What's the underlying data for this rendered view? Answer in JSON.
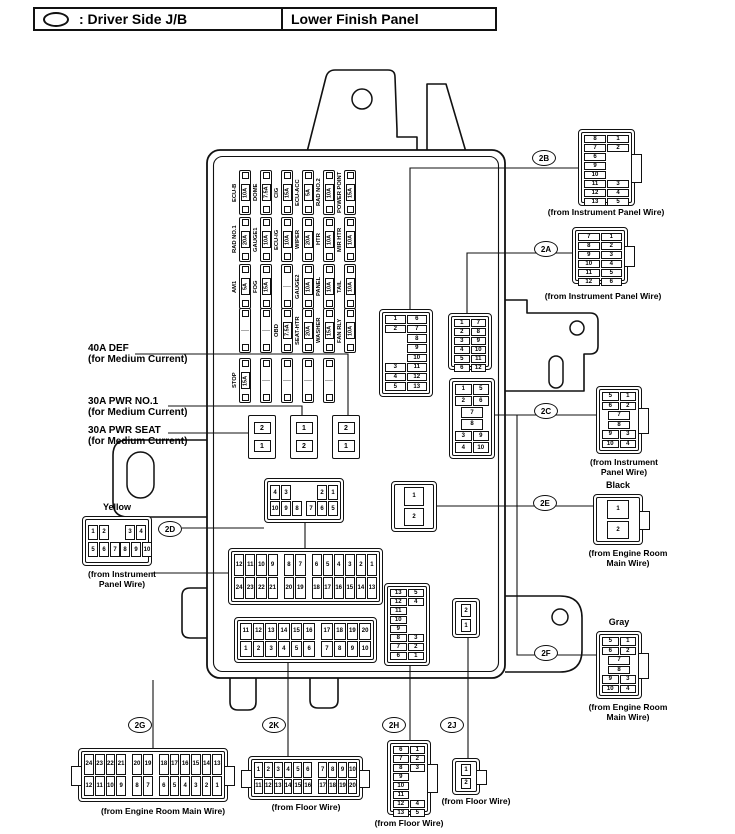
{
  "header": {
    "legend_symbol": "oval-icon",
    "legend_label": ": Driver Side J/B",
    "location_label": "Lower Finish Panel"
  },
  "medium_current_labels": [
    {
      "line1": "40A DEF",
      "line2": "(for Medium Current)"
    },
    {
      "line1": "30A PWR NO.1",
      "line2": "(for Medium Current)"
    },
    {
      "line1": "30A PWR SEAT",
      "line2": "(for Medium Current)"
    }
  ],
  "medium_current_blocks": [
    [
      "2",
      "1"
    ],
    [
      "1",
      "2"
    ],
    [
      "2",
      "1"
    ]
  ],
  "fuse_rows": [
    {
      "fuses": [
        {
          "name": "ECU-B",
          "rating": "10A"
        },
        {
          "name": "DOME",
          "rating": "7.5A"
        },
        {
          "name": "CIG",
          "rating": "15A"
        },
        {
          "name": "ECU-ACC",
          "rating": "5A"
        },
        {
          "name": "RAD NO.2",
          "rating": "10A"
        },
        {
          "name": "POWER POINT",
          "rating": "15A"
        }
      ]
    },
    {
      "fuses": [
        {
          "name": "RAD NO.1",
          "rating": "20A"
        },
        {
          "name": "GAUGE1",
          "rating": "10A"
        },
        {
          "name": "ECU-IG",
          "rating": "10A"
        },
        {
          "name": "WIPER",
          "rating": "20A"
        },
        {
          "name": "HTR",
          "rating": "10A"
        },
        {
          "name": "MIR HTR",
          "rating": "10A"
        }
      ]
    },
    {
      "fuses": [
        {
          "name": "AM1",
          "rating": "5A"
        },
        {
          "name": "FOG",
          "rating": "15A"
        },
        {
          "blank": true
        },
        {
          "name": "GAUGE2",
          "rating": "10A"
        },
        {
          "name": "PANEL",
          "rating": "10A"
        },
        {
          "name": "TAIL",
          "rating": "10A"
        }
      ]
    },
    {
      "fuses": [
        {
          "blank": true
        },
        {
          "blank": true
        },
        {
          "name": "OBD",
          "rating": "7.5A"
        },
        {
          "name": "SEAT-HTR",
          "rating": "20A"
        },
        {
          "name": "WASHER",
          "rating": "15A"
        },
        {
          "name": "FAN RLY",
          "rating": "10A"
        }
      ]
    },
    {
      "fuses": [
        {
          "name": "STOP",
          "rating": "15A"
        },
        {
          "blank": true
        },
        {
          "blank": true
        },
        {
          "blank": true
        },
        {
          "blank": true
        }
      ]
    }
  ],
  "connectors": [
    {
      "id": "jb2b",
      "type": "pairs",
      "pins": [
        [
          "1",
          "6"
        ],
        [
          "2",
          "7"
        ],
        [
          "",
          "8"
        ],
        [
          "",
          "9"
        ],
        [
          "",
          "10"
        ],
        [
          "3",
          "11"
        ],
        [
          "4",
          "12"
        ],
        [
          "5",
          "13"
        ]
      ]
    },
    {
      "id": "jb2a",
      "type": "pairs",
      "pins": [
        [
          "1",
          "7"
        ],
        [
          "2",
          "8"
        ],
        [
          "3",
          "9"
        ],
        [
          "4",
          "10"
        ],
        [
          "5",
          "11"
        ],
        [
          "6",
          "12"
        ]
      ]
    },
    {
      "id": "jb2c",
      "type": "pairs",
      "pins": [
        [
          "1",
          "5"
        ],
        [
          "2",
          "6"
        ],
        [
          "7"
        ],
        [
          "8"
        ],
        [
          "3",
          "9"
        ],
        [
          "4",
          "10"
        ]
      ]
    },
    {
      "id": "jb2d",
      "type": "dgroups",
      "pins": {
        "top": [
          [
            "4",
            "3"
          ],
          [
            "2",
            "1"
          ]
        ],
        "bottom": [
          [
            "10",
            "9",
            "8"
          ],
          [
            "7",
            "6",
            "5"
          ]
        ]
      }
    },
    {
      "id": "jb2e",
      "type": "vstack",
      "pins": [
        "1",
        "2"
      ]
    },
    {
      "id": "jb2g",
      "type": "groups",
      "pins": {
        "top": [
          [
            "12",
            "11",
            "10",
            "9"
          ],
          [
            "8",
            "7"
          ],
          [
            "6",
            "5",
            "4",
            "3",
            "2",
            "1"
          ]
        ],
        "bottom": [
          [
            "24",
            "23",
            "22",
            "21"
          ],
          [
            "20",
            "19"
          ],
          [
            "18",
            "17",
            "16",
            "15",
            "14",
            "13"
          ]
        ]
      }
    },
    {
      "id": "jb2k",
      "type": "groups",
      "pins": {
        "top": [
          [
            "11",
            "12",
            "13",
            "14",
            "15",
            "16"
          ],
          [
            "17",
            "18",
            "19",
            "20"
          ]
        ],
        "bottom": [
          [
            "1",
            "2",
            "3",
            "4",
            "5",
            "6"
          ],
          [
            "7",
            "8",
            "9",
            "10"
          ]
        ]
      }
    },
    {
      "id": "jb2h",
      "type": "pairs",
      "pins": [
        [
          "13",
          "5"
        ],
        [
          "12",
          "4"
        ],
        [
          "11",
          ""
        ],
        [
          "10",
          ""
        ],
        [
          "9",
          ""
        ],
        [
          "8",
          "3"
        ],
        [
          "7",
          "2"
        ],
        [
          "6",
          "1"
        ]
      ]
    },
    {
      "id": "jb2j",
      "type": "vstack",
      "pins": [
        "2",
        "1"
      ]
    },
    {
      "id": "ext2b",
      "type": "pairs",
      "ref": "2B",
      "caption": "(from Instrument Panel Wire)",
      "pins": [
        [
          "8",
          "1"
        ],
        [
          "7",
          "2"
        ],
        [
          "6",
          ""
        ],
        [
          "9",
          ""
        ],
        [
          "10",
          ""
        ],
        [
          "11",
          "3"
        ],
        [
          "12",
          "4"
        ],
        [
          "13",
          "5"
        ]
      ]
    },
    {
      "id": "ext2a",
      "type": "pairs",
      "ref": "2A",
      "caption": "(from Instrument Panel Wire)",
      "pins": [
        [
          "7",
          "1"
        ],
        [
          "8",
          "2"
        ],
        [
          "9",
          "3"
        ],
        [
          "10",
          "4"
        ],
        [
          "11",
          "5"
        ],
        [
          "12",
          "6"
        ]
      ]
    },
    {
      "id": "ext2c",
      "type": "pairs",
      "ref": "2C",
      "caption": "(from Instrument\nPanel Wire)",
      "pins": [
        [
          "5",
          "1"
        ],
        [
          "6",
          "2"
        ],
        [
          "7"
        ],
        [
          "8"
        ],
        [
          "9",
          "3"
        ],
        [
          "10",
          "4"
        ]
      ]
    },
    {
      "id": "ext2e",
      "type": "vstack",
      "ref": "2E",
      "color_label": "Black",
      "caption": "(from Engine Room\nMain Wire)",
      "pins": [
        "1",
        "2"
      ]
    },
    {
      "id": "ext2f",
      "type": "pairs",
      "ref": "2F",
      "color_label": "Gray",
      "caption": "(from Engine Room\nMain Wire)",
      "pins": [
        [
          "5",
          "1"
        ],
        [
          "6",
          "2"
        ],
        [
          "7"
        ],
        [
          "8"
        ],
        [
          "9",
          "3"
        ],
        [
          "10",
          "4"
        ]
      ]
    },
    {
      "id": "extyellow",
      "type": "dgroups",
      "ref": "2D",
      "color_label": "Yellow",
      "caption": "(from Instrument\nPanel Wire)",
      "pins": {
        "top": [
          [
            "1",
            "2"
          ],
          [
            "3",
            "4"
          ]
        ],
        "bottom": [
          [
            "5",
            "6",
            "7"
          ],
          [
            "8",
            "9",
            "10"
          ]
        ]
      }
    },
    {
      "id": "ext2g",
      "type": "groups",
      "ref": "2G",
      "caption": "(from Engine Room Main Wire)",
      "pins": {
        "top": [
          [
            "24",
            "23",
            "22",
            "21"
          ],
          [
            "20",
            "19"
          ],
          [
            "18",
            "17",
            "16",
            "15",
            "14",
            "13"
          ]
        ],
        "bottom": [
          [
            "12",
            "11",
            "10",
            "9"
          ],
          [
            "8",
            "7"
          ],
          [
            "6",
            "5",
            "4",
            "3",
            "2",
            "1"
          ]
        ]
      }
    },
    {
      "id": "ext2k",
      "type": "groups",
      "ref": "2K",
      "caption": "(from Floor Wire)",
      "pins": {
        "top": [
          [
            "1",
            "2",
            "3",
            "4",
            "5",
            "6"
          ],
          [
            "7",
            "8",
            "9",
            "10"
          ]
        ],
        "bottom": [
          [
            "11",
            "12",
            "13",
            "14",
            "15",
            "16"
          ],
          [
            "17",
            "18",
            "19",
            "20"
          ]
        ]
      }
    },
    {
      "id": "ext2h",
      "type": "pairs",
      "ref": "2H",
      "caption": "(from Floor Wire)",
      "pins": [
        [
          "6",
          "1"
        ],
        [
          "7",
          "2"
        ],
        [
          "8",
          "3"
        ],
        [
          "9",
          ""
        ],
        [
          "10",
          ""
        ],
        [
          "11",
          ""
        ],
        [
          "12",
          "4"
        ],
        [
          "13",
          "5"
        ]
      ]
    },
    {
      "id": "ext2j",
      "type": "vstack",
      "ref": "2J",
      "caption": "(from Floor Wire)",
      "pins": [
        "1",
        "2"
      ]
    }
  ]
}
